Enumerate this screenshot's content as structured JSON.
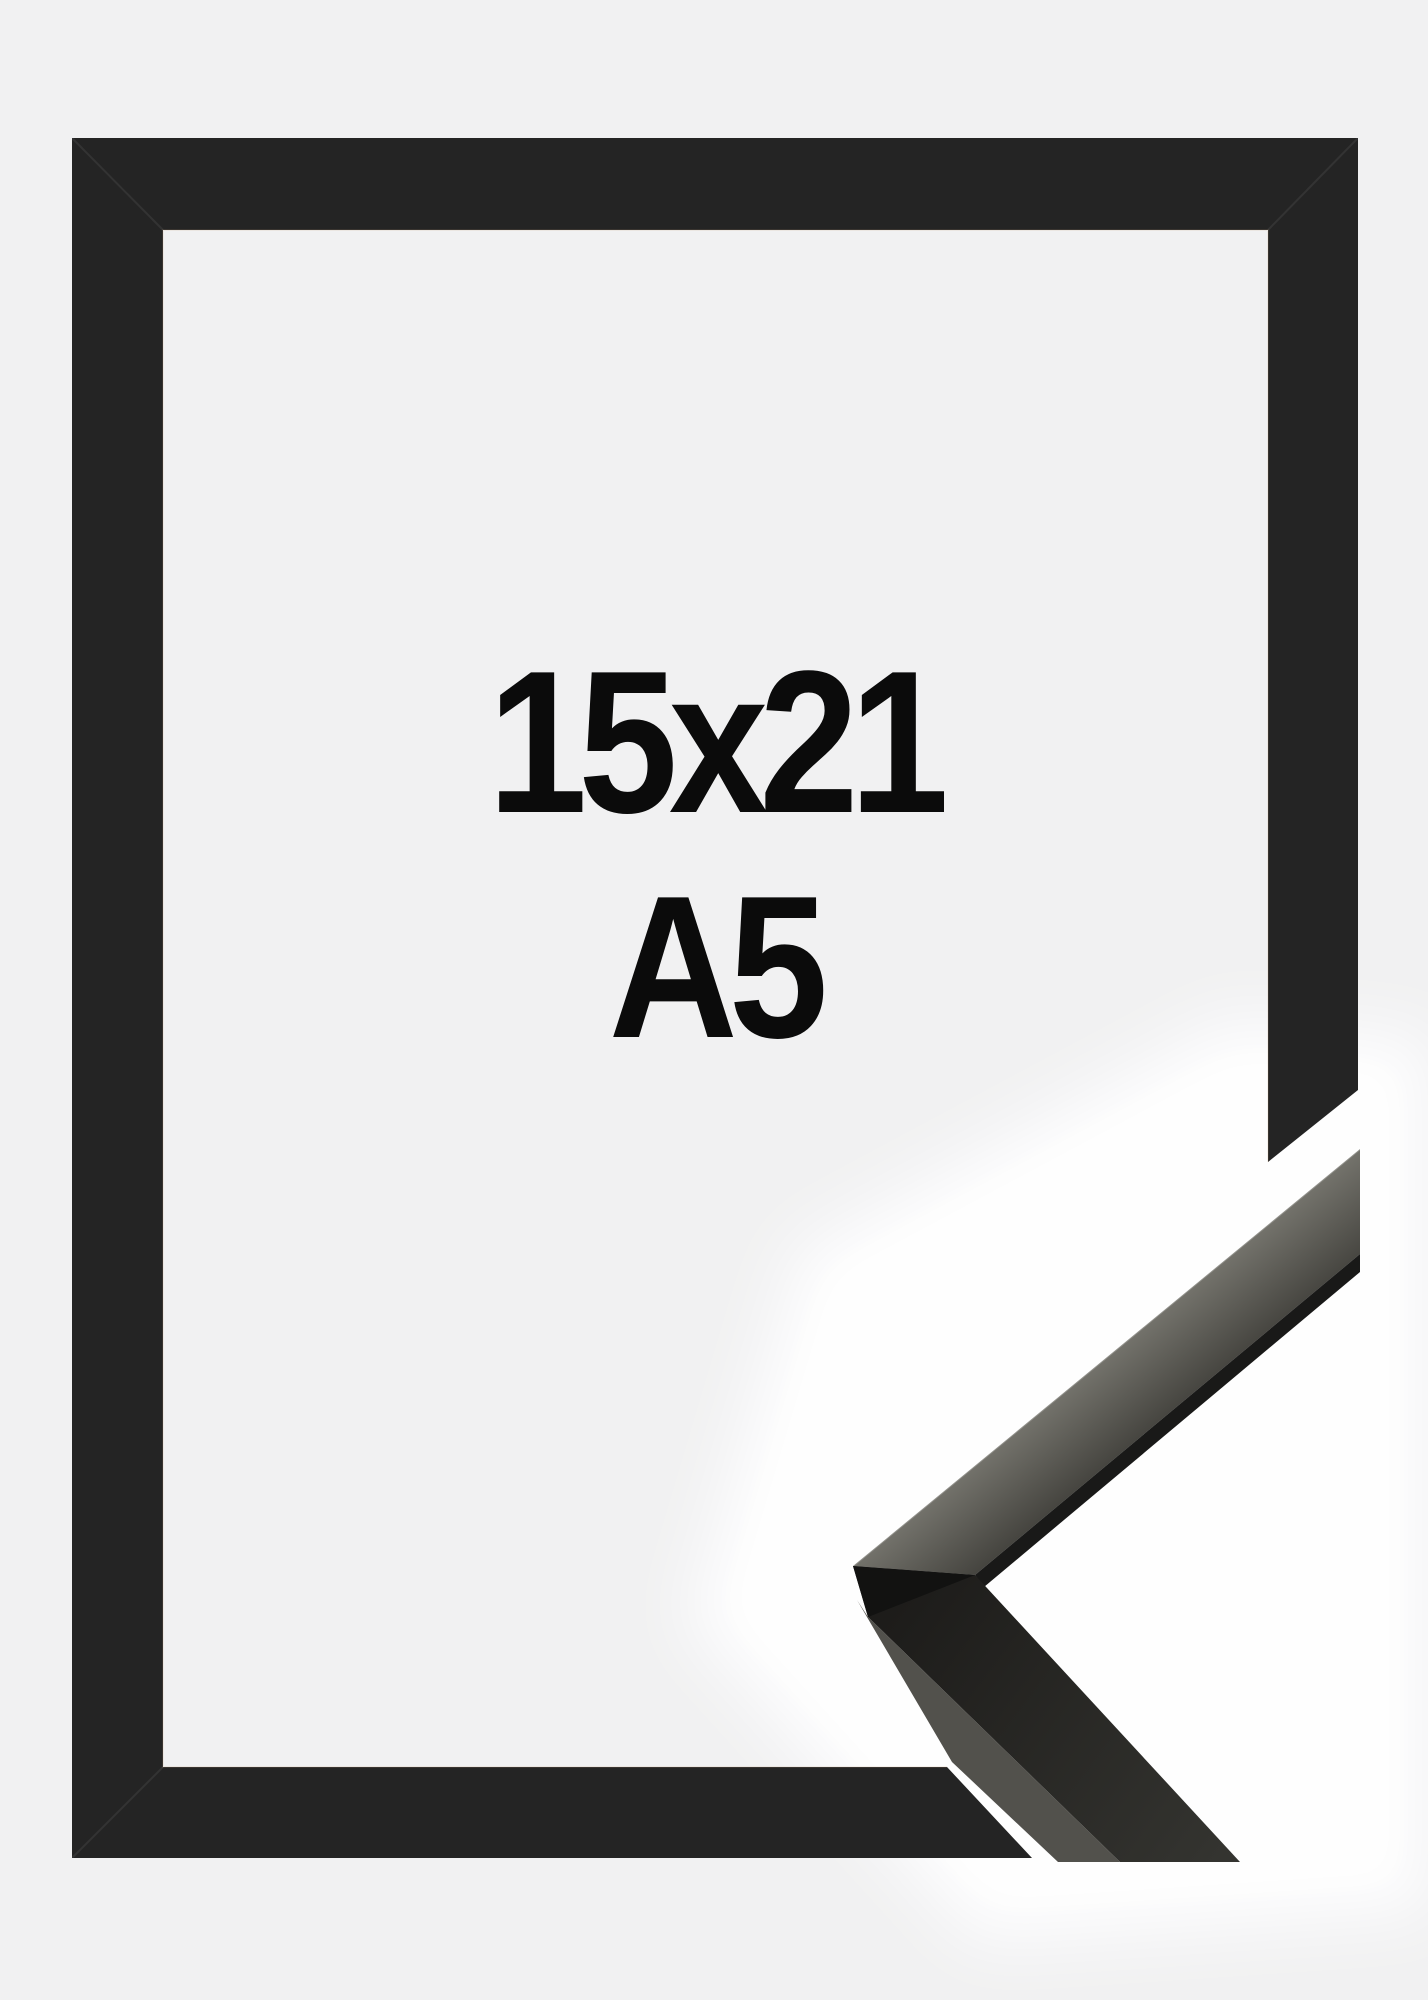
{
  "meta": {
    "description": "Product photo of a black picture frame with a detached mitered corner sample of the moulding shown at lower right"
  },
  "overlay": {
    "size_label": "15x21",
    "format_label": "A5"
  },
  "colors": {
    "background": "#f1f1f2",
    "backdrop_white": "#ffffff",
    "frame_black": "#242424",
    "corner_face_light": "#73726b",
    "corner_face_mid": "#45443f",
    "corner_seam": "#191918",
    "corner_lower_dark": "#1d1c1a",
    "corner_lower_light": "#343430",
    "corner_side": "#52514c",
    "corner_facet": "#121211",
    "text": "#0b0b0b"
  }
}
